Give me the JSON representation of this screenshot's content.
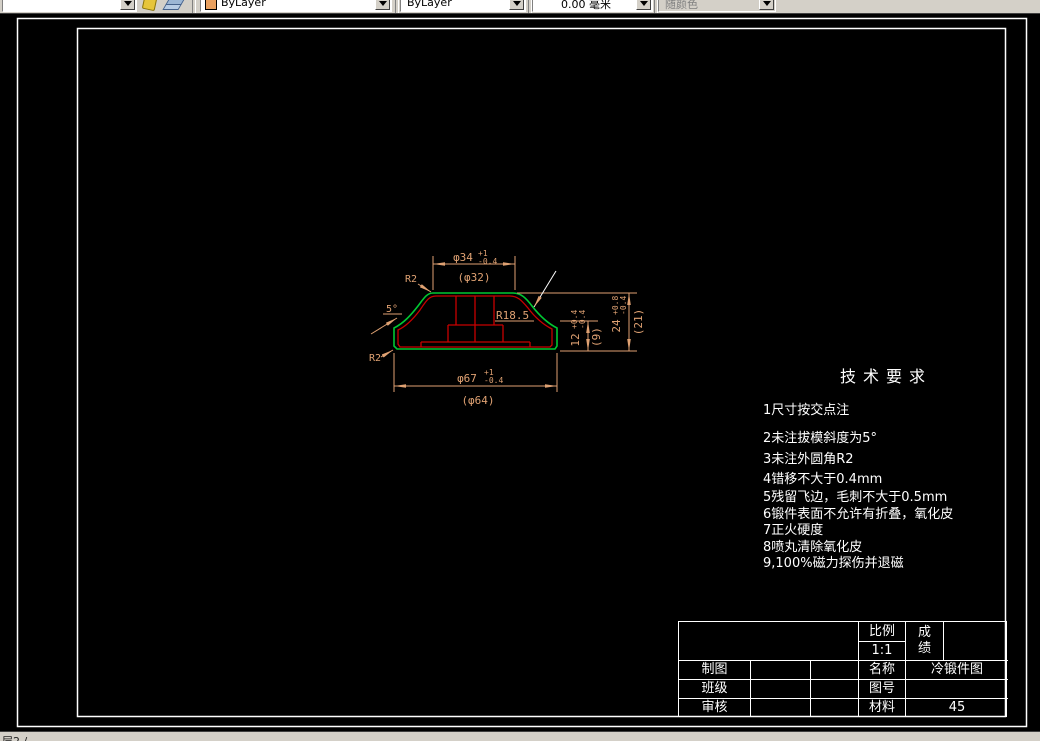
{
  "toolbar": {
    "color_combo": {
      "value": "ByLayer",
      "swatch_color": "#E8A060"
    },
    "linetype_combo": {
      "value": "ByLayer"
    },
    "lineweight_combo": {
      "value": "0.00 毫米"
    },
    "plotstyle_combo": {
      "value": "随颜色"
    }
  },
  "drawing": {
    "labels": {
      "r2_top": "R2",
      "angle": "5°",
      "r2_bottom": "R2",
      "fillet": "R18.5"
    },
    "dimensions": {
      "top": {
        "main": "φ34",
        "tol_up": "+1",
        "tol_dn": "-0.4",
        "ref": "(φ32)"
      },
      "bottom": {
        "main": "φ67",
        "tol_up": "+1",
        "tol_dn": "-0.4",
        "ref": "(φ64)"
      },
      "right_outer": {
        "main": "24",
        "tol_up": "+0.8",
        "tol_dn": "-0.4",
        "ref": "(21)"
      },
      "right_inner": {
        "main": "12",
        "tol_up": "+0.4",
        "tol_dn": "-0.4",
        "ref": "(9)"
      }
    },
    "colors": {
      "outline_green": "#00C832",
      "outline_red": "#C80000",
      "dimension": "#DFA172",
      "leader_white": "#FFFFFF"
    }
  },
  "tech_requirements": {
    "title": "技术要求",
    "items": [
      "1尺寸按交点注",
      "2未注拔模斜度为5°",
      "3未注外圆角R2",
      "4错移不大于0.4mm",
      "5残留飞边，毛刺不大于0.5mm",
      "6锻件表面不允许有折叠，氧化皮",
      "7正火硬度",
      "8喷丸清除氧化皮",
      "9,100%磁力探伤并退磁"
    ]
  },
  "title_block": {
    "scale_label": "比例",
    "scale_value": "1:1",
    "grade_label": "成绩",
    "drafter_label": "制图",
    "class_label": "班级",
    "checker_label": "审核",
    "name_label": "名称",
    "name_value": "冷锻件图",
    "drawno_label": "图号",
    "drawno_value": "",
    "material_label": "材料",
    "material_value": "45"
  },
  "status_bar": {
    "fragment": "层2 /"
  }
}
